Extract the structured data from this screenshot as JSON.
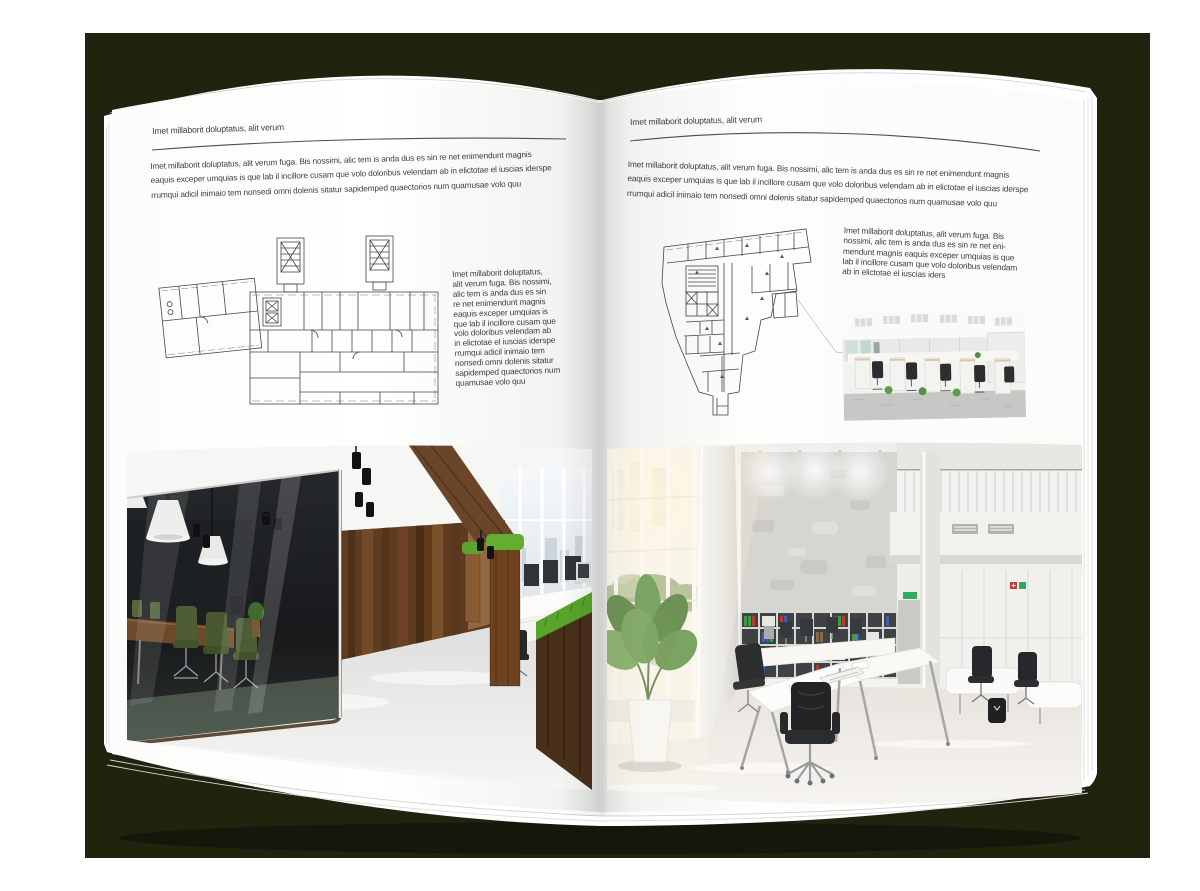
{
  "backdrop": {
    "color": "#20240f"
  },
  "pages": {
    "color": "#ffffff"
  },
  "left_page": {
    "kicker": "Imet millaborit doluptatus, alit verum",
    "intro": "Imet millaborit doluptatus, alit verum fuga. Bis nossimi, alic tem is anda dus es sin re net enimendunt magnis\neaquis exceper umquias is que lab il incillore cusam que volo doloribus velendam ab in elictotae el iuscias iderspe\nrrumqui adicil inimaio tem nonsedi omni dolenis sitatur sapidemped quaectorios num quamusae volo quu",
    "side_text": "Imet millaborit doluptatus,\nalit verum fuga. Bis nossimi,\nalic tem is anda dus es sin\nre net enimendunt magnis\neaquis exceper umquias is\nque lab il incillore cusam que\nvolo doloribus velendam ab\nin elictotae el iuscias iderspe\nrrumqui adicil inimaio tem\nnonsedi omni dolenis sitatur\nsapidemped quaectorios num\nquamusae volo quu",
    "artwork": {
      "floorplan": "architectural-floor-plan-with-stair-towers",
      "photo": "loft-office-glass-meeting-room-photo"
    }
  },
  "right_page": {
    "kicker": "Imet millaborit doluptatus, alit verum",
    "intro": "Imet millaborit doluptatus, alit verum fuga. Bis nossimi, alic tem is anda dus es sin re net enimendunt magnis\neaquis exceper umquias is que lab il incillore cusam que volo doloribus velendam ab in elictotae el iuscias iderspe\nrrumqui adicil inimaio tem nonsedi omni dolenis sitatur sapidemped quaectorios num quamusae volo quu",
    "side_text": "Imet millaborit doluptatus, alit verum fuga. Bis\nnossimi, alic tem is anda dus es sin re net eni-\nmendunt magnis eaquis exceper umquias is que\nlab il incillore cusam que volo doloribus velendam\nab in elictotae el iuscias iders",
    "artwork": {
      "floorplan": "irregular-building-floor-plan",
      "photo_small": "open-plan-cubicle-office-photo",
      "photo_large": "double-height-atrium-office-photo"
    }
  }
}
